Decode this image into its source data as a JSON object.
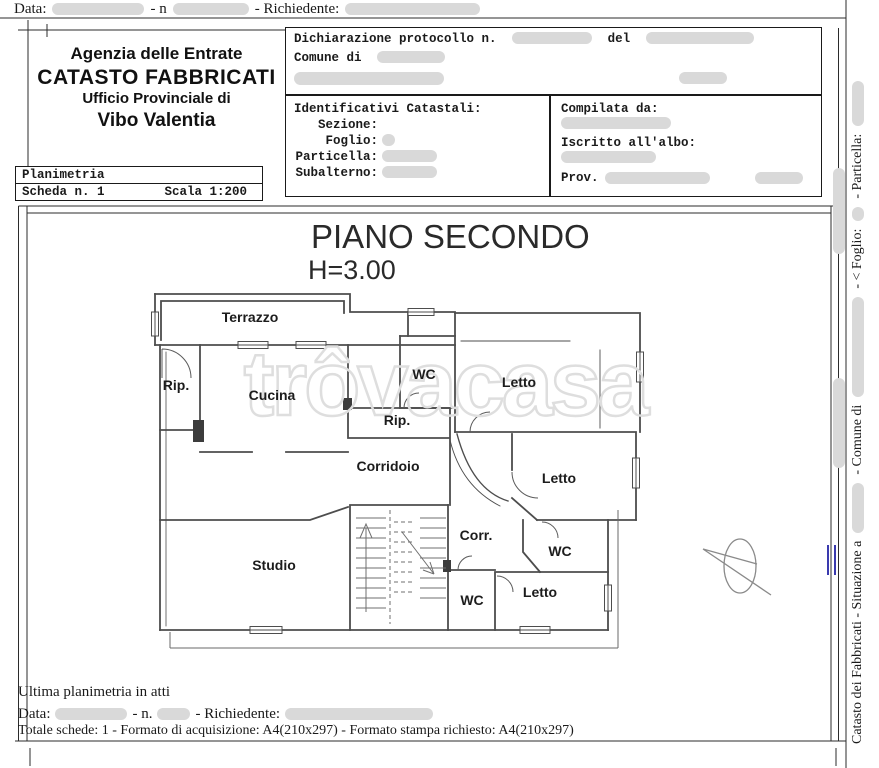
{
  "colors": {
    "redaction": "#d9d9d9",
    "wall": "#4d4d4d",
    "accent_blue": "#3a3aae",
    "watermark": "#dedede"
  },
  "top_strip": {
    "data_label": "Data:",
    "n_label": "- n",
    "richiedente_label": "- Richiedente:"
  },
  "office_header": {
    "line1": "Agenzia delle Entrate",
    "line2": "CATASTO FABBRICATI",
    "line3": "Ufficio Provinciale di",
    "line4": "Vibo Valentia"
  },
  "declaration": {
    "protocollo_label": "Dichiarazione protocollo n.",
    "del_label": "del",
    "comune_label": "Comune di"
  },
  "identificativi": {
    "title": "Identificativi Catastali:",
    "sezione_label": "Sezione:",
    "foglio_label": "Foglio:",
    "particella_label": "Particella:",
    "subalterno_label": "Subalterno:"
  },
  "compilata": {
    "title": "Compilata da:",
    "iscritto_label": "Iscritto all'albo:",
    "prov_label": "Prov."
  },
  "planimetria": {
    "title": "Planimetria",
    "scheda": "Scheda n. 1",
    "scala": "Scala 1:200"
  },
  "plan": {
    "title": "PIANO SECONDO",
    "height_label": "H=3.00",
    "watermark": "trôvacasa",
    "rooms": [
      {
        "label": "Terrazzo"
      },
      {
        "label": "Rip."
      },
      {
        "label": "Cucina"
      },
      {
        "label": "WC"
      },
      {
        "label": "Letto"
      },
      {
        "label": "Rip."
      },
      {
        "label": "Corridoio"
      },
      {
        "label": "Letto"
      },
      {
        "label": "Corr."
      },
      {
        "label": "WC"
      },
      {
        "label": "Studio"
      },
      {
        "label": "WC"
      },
      {
        "label": "Letto"
      }
    ]
  },
  "side_margin": {
    "segment1": "Catasto dei Fabbricati - Situazione a",
    "segment2": "- Comune di",
    "segment3": "- < Foglio:",
    "segment4": "- Particella:"
  },
  "footer": {
    "ultima": "Ultima planimetria in atti",
    "data_label": "Data:",
    "n_label": "- n.",
    "richiedente_label": "- Richiedente:",
    "totale": "Totale schede: 1 - Formato di acquisizione: A4(210x297)  - Formato stampa richiesto: A4(210x297)"
  }
}
